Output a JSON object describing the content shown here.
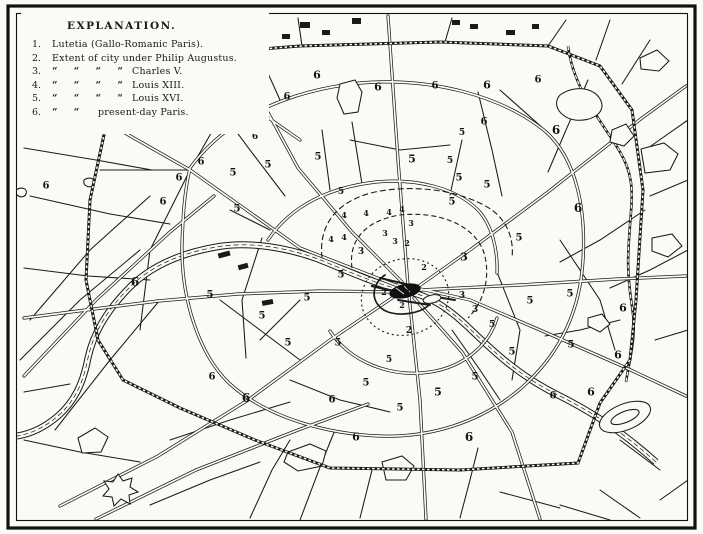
{
  "legend": {
    "title": "EXPLANATION.",
    "items": [
      {
        "num": "1.",
        "dittos": "",
        "text": "Lutetia (Gallo-Romanic Paris)."
      },
      {
        "num": "2.",
        "dittos": "",
        "text": "Extent of city under Philip Augustus."
      },
      {
        "num": "3.",
        "dittos": "“ “ “ “",
        "text": "Charles V."
      },
      {
        "num": "4.",
        "dittos": "“ “ “ “",
        "text": "Louis XIII."
      },
      {
        "num": "5.",
        "dittos": "“ “ “ “",
        "text": "Louis XVI."
      },
      {
        "num": "6.",
        "dittos": "“ “",
        "text": "present-day Paris."
      }
    ]
  },
  "map": {
    "colors": {
      "ink": "#1a1a1a",
      "paper": "#fbfaf6"
    },
    "labels": [
      {
        "n": "1",
        "x": 408,
        "y": 290,
        "s": 8
      },
      {
        "n": "2",
        "x": 407,
        "y": 243,
        "s": 8
      },
      {
        "n": "2",
        "x": 424,
        "y": 267,
        "s": 8
      },
      {
        "n": "2",
        "x": 384,
        "y": 292,
        "s": 8
      },
      {
        "n": "2",
        "x": 402,
        "y": 305,
        "s": 8
      },
      {
        "n": "2",
        "x": 409,
        "y": 331,
        "s": 9
      },
      {
        "n": "3",
        "x": 411,
        "y": 223,
        "s": 8
      },
      {
        "n": "3",
        "x": 385,
        "y": 233,
        "s": 8
      },
      {
        "n": "3",
        "x": 395,
        "y": 241,
        "s": 8
      },
      {
        "n": "3",
        "x": 361,
        "y": 252,
        "s": 9
      },
      {
        "n": "3",
        "x": 464,
        "y": 257,
        "s": 11
      },
      {
        "n": "3",
        "x": 462,
        "y": 296,
        "s": 9
      },
      {
        "n": "3",
        "x": 475,
        "y": 310,
        "s": 9
      },
      {
        "n": "4",
        "x": 344,
        "y": 215,
        "s": 8
      },
      {
        "n": "4",
        "x": 366,
        "y": 213,
        "s": 8
      },
      {
        "n": "4",
        "x": 389,
        "y": 212,
        "s": 8
      },
      {
        "n": "4",
        "x": 402,
        "y": 209,
        "s": 8
      },
      {
        "n": "4",
        "x": 331,
        "y": 239,
        "s": 8
      },
      {
        "n": "4",
        "x": 344,
        "y": 237,
        "s": 8
      },
      {
        "n": "5",
        "x": 268,
        "y": 165,
        "s": 10
      },
      {
        "n": "5",
        "x": 318,
        "y": 157,
        "s": 10
      },
      {
        "n": "5",
        "x": 412,
        "y": 159,
        "s": 11
      },
      {
        "n": "5",
        "x": 450,
        "y": 161,
        "s": 9
      },
      {
        "n": "5",
        "x": 462,
        "y": 133,
        "s": 9
      },
      {
        "n": "5",
        "x": 459,
        "y": 178,
        "s": 10
      },
      {
        "n": "5",
        "x": 487,
        "y": 185,
        "s": 10
      },
      {
        "n": "5",
        "x": 452,
        "y": 202,
        "s": 10
      },
      {
        "n": "5",
        "x": 519,
        "y": 238,
        "s": 10
      },
      {
        "n": "5",
        "x": 530,
        "y": 301,
        "s": 10
      },
      {
        "n": "5",
        "x": 570,
        "y": 294,
        "s": 10
      },
      {
        "n": "5",
        "x": 492,
        "y": 325,
        "s": 9
      },
      {
        "n": "5",
        "x": 512,
        "y": 352,
        "s": 10
      },
      {
        "n": "5",
        "x": 571,
        "y": 345,
        "s": 10
      },
      {
        "n": "5",
        "x": 475,
        "y": 377,
        "s": 10
      },
      {
        "n": "5",
        "x": 438,
        "y": 392,
        "s": 11
      },
      {
        "n": "5",
        "x": 389,
        "y": 360,
        "s": 9
      },
      {
        "n": "5",
        "x": 366,
        "y": 383,
        "s": 10
      },
      {
        "n": "5",
        "x": 400,
        "y": 408,
        "s": 10
      },
      {
        "n": "5",
        "x": 338,
        "y": 343,
        "s": 10
      },
      {
        "n": "5",
        "x": 341,
        "y": 275,
        "s": 10
      },
      {
        "n": "5",
        "x": 307,
        "y": 298,
        "s": 10
      },
      {
        "n": "5",
        "x": 341,
        "y": 192,
        "s": 9
      },
      {
        "n": "5",
        "x": 237,
        "y": 209,
        "s": 10
      },
      {
        "n": "5",
        "x": 233,
        "y": 173,
        "s": 10
      },
      {
        "n": "5",
        "x": 210,
        "y": 295,
        "s": 10
      },
      {
        "n": "5",
        "x": 262,
        "y": 316,
        "s": 10
      },
      {
        "n": "5",
        "x": 288,
        "y": 343,
        "s": 10
      },
      {
        "n": "6",
        "x": 317,
        "y": 75,
        "s": 11
      },
      {
        "n": "6",
        "x": 287,
        "y": 97,
        "s": 10
      },
      {
        "n": "6",
        "x": 378,
        "y": 87,
        "s": 11
      },
      {
        "n": "6",
        "x": 435,
        "y": 86,
        "s": 10
      },
      {
        "n": "6",
        "x": 487,
        "y": 85,
        "s": 11
      },
      {
        "n": "6",
        "x": 538,
        "y": 80,
        "s": 10
      },
      {
        "n": "6",
        "x": 556,
        "y": 130,
        "s": 12
      },
      {
        "n": "6",
        "x": 578,
        "y": 208,
        "s": 12
      },
      {
        "n": "6",
        "x": 623,
        "y": 308,
        "s": 11
      },
      {
        "n": "6",
        "x": 618,
        "y": 355,
        "s": 11
      },
      {
        "n": "6",
        "x": 591,
        "y": 392,
        "s": 11
      },
      {
        "n": "6",
        "x": 553,
        "y": 396,
        "s": 10
      },
      {
        "n": "6",
        "x": 469,
        "y": 437,
        "s": 12
      },
      {
        "n": "6",
        "x": 356,
        "y": 437,
        "s": 11
      },
      {
        "n": "6",
        "x": 332,
        "y": 400,
        "s": 10
      },
      {
        "n": "6",
        "x": 246,
        "y": 398,
        "s": 12
      },
      {
        "n": "6",
        "x": 212,
        "y": 377,
        "s": 10
      },
      {
        "n": "6",
        "x": 135,
        "y": 282,
        "s": 12
      },
      {
        "n": "6",
        "x": 163,
        "y": 202,
        "s": 10
      },
      {
        "n": "6",
        "x": 179,
        "y": 178,
        "s": 10
      },
      {
        "n": "6",
        "x": 201,
        "y": 162,
        "s": 10
      },
      {
        "n": "6",
        "x": 217,
        "y": 120,
        "s": 10
      },
      {
        "n": "6",
        "x": 255,
        "y": 137,
        "s": 9
      },
      {
        "n": "6",
        "x": 46,
        "y": 186,
        "s": 10
      },
      {
        "n": "6",
        "x": 484,
        "y": 122,
        "s": 10
      }
    ]
  }
}
